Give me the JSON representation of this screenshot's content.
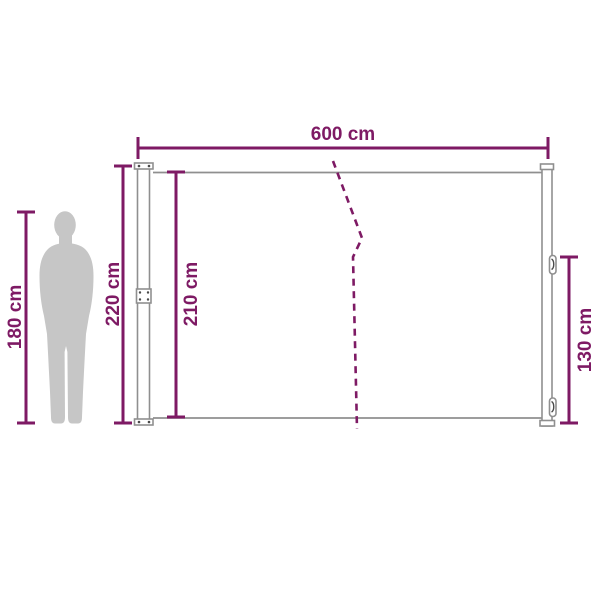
{
  "diagram": {
    "title": "Retractable side awning dimension diagram",
    "unit": "cm",
    "labels": {
      "width": "600 cm",
      "post_height": "220 cm",
      "fabric_height": "210 cm",
      "person_height": "180 cm",
      "handle_height": "130 cm"
    },
    "values": {
      "width": 600,
      "post_height": 220,
      "fabric_height": 210,
      "person_height": 180,
      "handle_height": 130
    },
    "icons": {
      "person": "standing-human-silhouette-for-scale"
    },
    "colors": {
      "dimension": "#7e1a64",
      "outline": "#8f8f8f",
      "silhouette": "#c6c6c6",
      "background": "#ffffff"
    }
  }
}
